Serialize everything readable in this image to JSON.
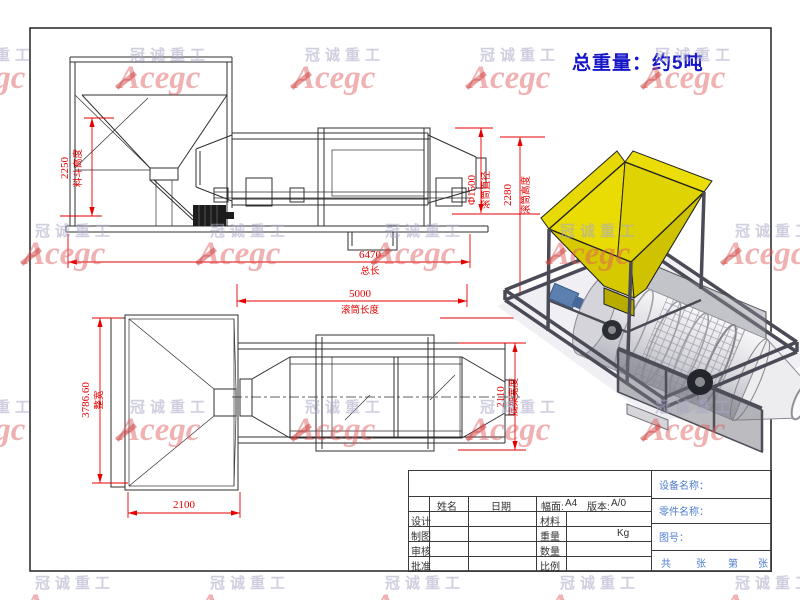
{
  "sheet": {
    "weight_note": "总重量：约5吨"
  },
  "watermark": {
    "company": "冠诚重工",
    "brand": "Acegc"
  },
  "dimensions": {
    "hopper_height": {
      "value": "2250",
      "label": "料斗高度"
    },
    "drum_diameter": {
      "value": "Φ1500",
      "label": "滚筒直径"
    },
    "drum_height": {
      "value": "2280",
      "label": "滚筒高度"
    },
    "total_length": {
      "value": "6470",
      "label": "总长"
    },
    "drum_length": {
      "value": "5000",
      "label": "滚筒长度"
    },
    "overall_width": {
      "value": "3786.60",
      "label": "整宽"
    },
    "base_width": {
      "value": "2110",
      "label": "底架宽度"
    },
    "hopper_width": {
      "value": "2100"
    }
  },
  "title_block": {
    "col_name": "姓名",
    "col_date": "日期",
    "format_label": "幅面:",
    "format_value": "A4",
    "version_label": "版本:",
    "version_value": "A/0",
    "rows": [
      {
        "role": "设计",
        "field": "材料",
        "value": ""
      },
      {
        "role": "制图",
        "field": "重量",
        "value": "Kg"
      },
      {
        "role": "审核",
        "field": "数量",
        "value": ""
      },
      {
        "role": "批准",
        "field": "比例",
        "value": ""
      }
    ],
    "device_name_label": "设备名称：",
    "part_name_label": "零件名称：",
    "drawing_no_label": "图号：",
    "sheet_tokens": [
      "共",
      "张",
      "第",
      "张"
    ]
  },
  "colors": {
    "dimension_red": "#e60000",
    "note_blue": "#1616c8",
    "titleblock_blue": "#4f7ed2",
    "hopper_yellow": "#e8d900",
    "frame_gray": "#4b4b57"
  }
}
